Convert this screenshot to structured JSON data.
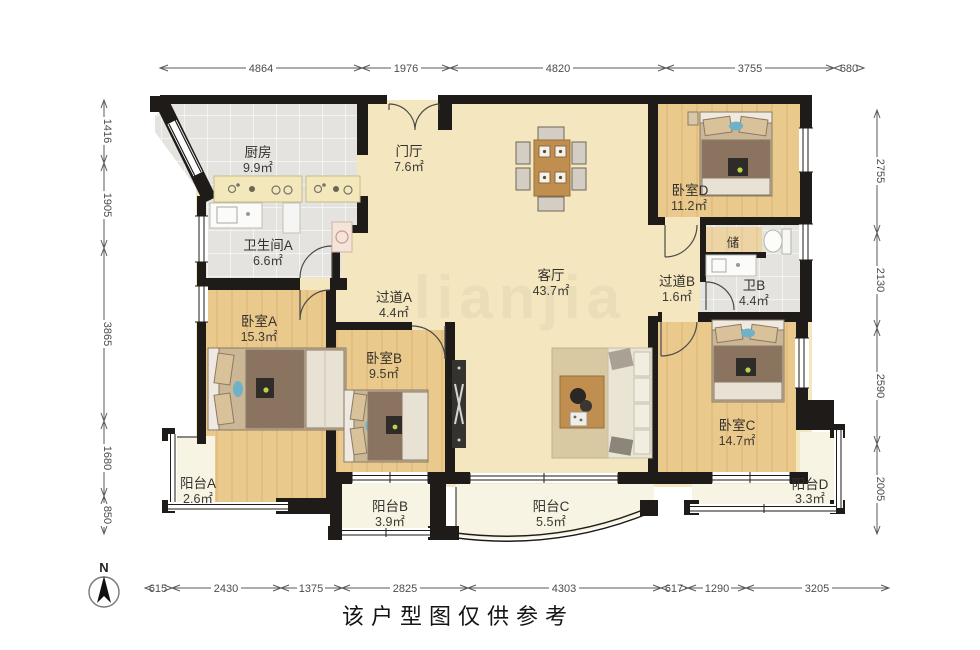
{
  "caption": "该户型图仅供参考",
  "compass": {
    "label": "N"
  },
  "watermark": "lianjia",
  "rooms": {
    "kitchen": {
      "name": "厨房",
      "area": "9.9㎡"
    },
    "foyer": {
      "name": "门厅",
      "area": "7.6㎡"
    },
    "bath_a": {
      "name": "卫生间A",
      "area": "6.6㎡"
    },
    "corridor_a": {
      "name": "过道A",
      "area": "4.4㎡"
    },
    "living": {
      "name": "客厅",
      "area": "43.7㎡"
    },
    "bedroom_d": {
      "name": "卧室D",
      "area": "11.2㎡"
    },
    "storage": {
      "name": "储"
    },
    "corridor_b": {
      "name": "过道B",
      "area": "1.6㎡"
    },
    "bath_b": {
      "name": "卫B",
      "area": "4.4㎡"
    },
    "bedroom_a": {
      "name": "卧室A",
      "area": "15.3㎡"
    },
    "bedroom_b": {
      "name": "卧室B",
      "area": "9.5㎡"
    },
    "bedroom_c": {
      "name": "卧室C",
      "area": "14.7㎡"
    },
    "balcony_a": {
      "name": "阳台A",
      "area": "2.6㎡"
    },
    "balcony_b": {
      "name": "阳台B",
      "area": "3.9㎡"
    },
    "balcony_c": {
      "name": "阳台C",
      "area": "5.5㎡"
    },
    "balcony_d": {
      "name": "阳台D",
      "area": "3.3㎡"
    }
  },
  "dimensions": {
    "top": [
      "4864",
      "1976",
      "4820",
      "3755",
      "680"
    ],
    "left": [
      "1416",
      "1905",
      "3865",
      "1680",
      "850"
    ],
    "right": [
      "2755",
      "2130",
      "2590",
      "2005"
    ],
    "bottom": [
      "615",
      "2430",
      "1375",
      "2825",
      "4303",
      "617",
      "1290",
      "3205"
    ]
  },
  "colors": {
    "wall": "#1f1b18",
    "main_floor": "#f6e8c2",
    "wood_floor": "#eac98c",
    "tile_floor": "#e4e3df",
    "balcony_floor": "#f8f4e3"
  }
}
